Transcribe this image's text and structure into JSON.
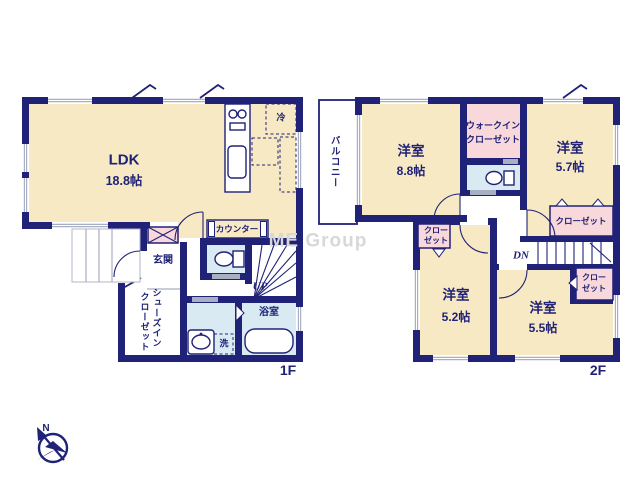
{
  "meta": {
    "floor1_label": "1F",
    "floor2_label": "2F",
    "watermark": "ME Group",
    "compass_north": "N"
  },
  "colors": {
    "wall_navy": "#202277",
    "room_cream": "#f7e9c3",
    "closet_pink": "#f8d8da",
    "water_blue": "#daeaf2",
    "window_gray": "#a9afc3",
    "watermark_gray": "#d8d8d8"
  },
  "floor1": {
    "ldk": {
      "name": "LDK",
      "size": "18.8帖"
    },
    "entrance": "玄関",
    "shoes_closet": [
      "シューズイン",
      "クローゼット"
    ],
    "counter": "カウンター",
    "bathroom": "浴室",
    "laundry": "洗",
    "fridge": "冷",
    "stairs_up": "UP"
  },
  "floor2": {
    "balcony": "バルコニー",
    "room_88": {
      "name": "洋室",
      "size": "8.8帖"
    },
    "wic": [
      "ウォークイン",
      "クローゼット"
    ],
    "room_57": {
      "name": "洋室",
      "size": "5.7帖"
    },
    "closet_57": "クローゼット",
    "closet_52": [
      "クロー",
      "ゼット"
    ],
    "room_52": {
      "name": "洋室",
      "size": "5.2帖"
    },
    "closet_55": [
      "クロー",
      "ゼット"
    ],
    "room_55": {
      "name": "洋室",
      "size": "5.5帖"
    },
    "stairs_down": "DN"
  }
}
